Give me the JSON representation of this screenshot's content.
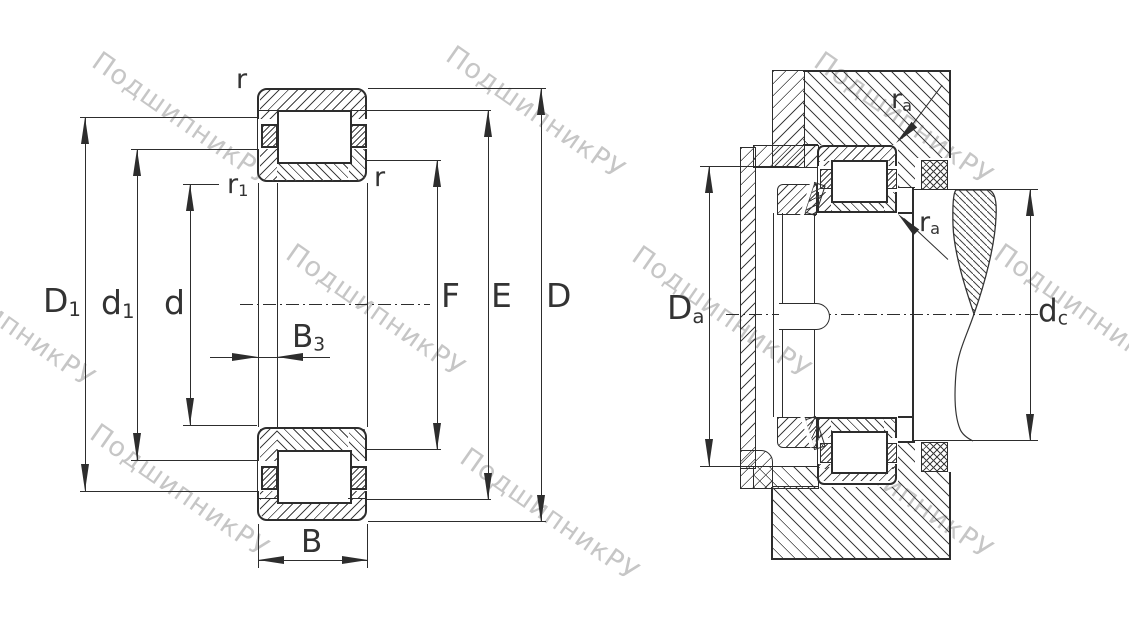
{
  "drawing": {
    "type": "bearing-technical-drawing",
    "left_view": "cylindrical-roller-bearing-cross-section",
    "right_view": "mounted-bearing-with-housing-and-shaft"
  },
  "labels": {
    "D1": {
      "base": "D",
      "sub": "1"
    },
    "d1": {
      "base": "d",
      "sub": "1"
    },
    "d": {
      "base": "d",
      "sub": ""
    },
    "B3": {
      "base": "B",
      "sub": "3"
    },
    "B": {
      "base": "B",
      "sub": ""
    },
    "F": {
      "base": "F",
      "sub": ""
    },
    "E": {
      "base": "E",
      "sub": ""
    },
    "D": {
      "base": "D",
      "sub": ""
    },
    "r": {
      "base": "r",
      "sub": ""
    },
    "r1": {
      "base": "r",
      "sub": "1"
    },
    "Da": {
      "base": "D",
      "sub": "a"
    },
    "dc": {
      "base": "d",
      "sub": "c"
    },
    "ra": {
      "base": "r",
      "sub": "a"
    }
  },
  "watermark": {
    "text": "ПодшипникРУ",
    "color": "#c6c6c6"
  },
  "colors": {
    "line": "#2d2d2d",
    "hatch": "#3f3f3f",
    "background": "#ffffff"
  }
}
